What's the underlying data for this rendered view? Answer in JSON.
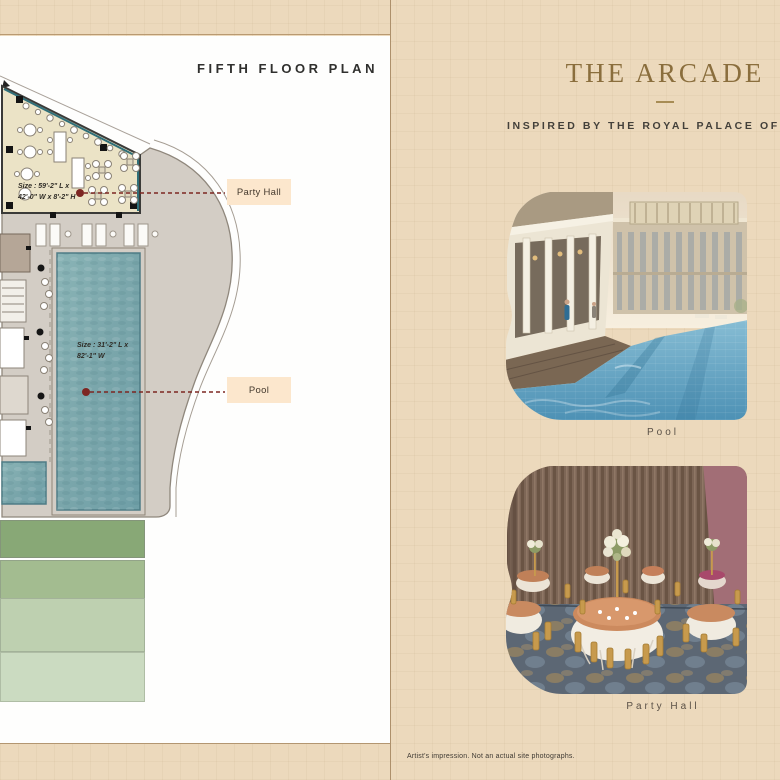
{
  "left_page": {
    "title": "FIFTH FLOOR PLAN",
    "plan": {
      "party_hall_size_l1": "Size : 59'-2\" L x",
      "party_hall_size_l2": "42'-0\" W x 8'-2\" H",
      "pool_size_l1": "Size : 31'-2\" L x",
      "pool_size_l2": "82'-1\" W",
      "tags": {
        "party_hall": "Party Hall",
        "pool": "Pool"
      }
    }
  },
  "right_page": {
    "title": "THE ARCADE",
    "subtitle": "INSPIRED BY THE ROYAL PALACE OF MA",
    "photos": [
      {
        "caption": "Pool"
      },
      {
        "caption": "Party Hall"
      }
    ],
    "disclaimer": "Artist's impression. Not an actual site photographs."
  },
  "colors": {
    "accent_gold": "#8a6e3d",
    "page_beige": "#ecd9bc",
    "label_peach": "#fce7cd",
    "marker_red": "#7d2622",
    "pool_teal": "#7fa9ae",
    "lawn_greens": [
      "#88a876",
      "#a3bc90",
      "#bed0b0",
      "#cbdbc1"
    ]
  }
}
